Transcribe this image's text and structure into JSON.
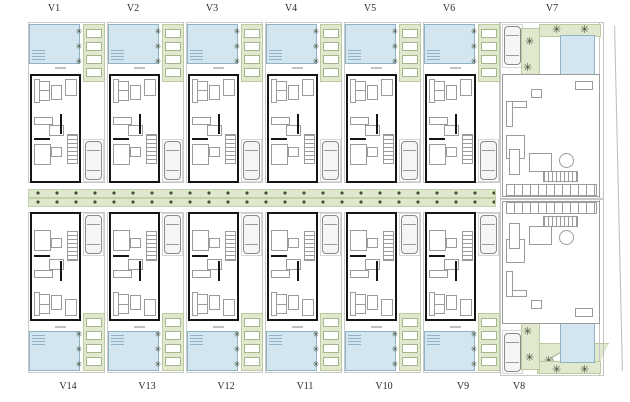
{
  "plan": {
    "top_row": [
      "V1",
      "V2",
      "V3",
      "V4",
      "V5",
      "V6"
    ],
    "bottom_row": [
      "V14",
      "V13",
      "V12",
      "V11",
      "V10",
      "V9"
    ],
    "right_top": "V7",
    "right_bottom": "V8"
  },
  "icons": {
    "plant_glyph": "✳"
  },
  "colors": {
    "pool_fill": "#d3e5ee",
    "pool_border": "#8fb3c4",
    "deck_fill": "#e0e9cd",
    "deck_border": "#bcca9f",
    "wall": "#151515",
    "furniture_line": "#9b9b9b",
    "lot_line": "#c9c9c9",
    "plant": "#3f4a35",
    "label_text": "#2b2b2b"
  }
}
